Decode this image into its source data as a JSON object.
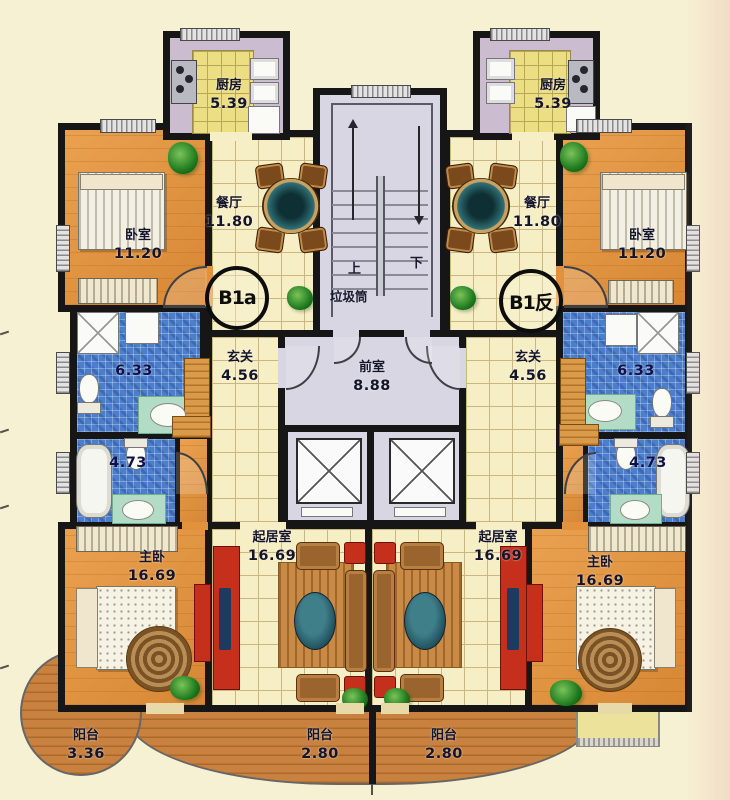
{
  "units": {
    "left": {
      "badge": "B1a",
      "kitchen": {
        "name": "厨房",
        "area": "5.39"
      },
      "dining": {
        "name": "餐厅",
        "area": "11.80"
      },
      "bedroom": {
        "name": "卧室",
        "area": "11.20"
      },
      "foyer": {
        "name": "玄关",
        "area": "4.56"
      },
      "bath_main": {
        "area": "6.33"
      },
      "bath_second": {
        "area": "4.73"
      },
      "living": {
        "name": "起居室",
        "area": "16.69"
      },
      "master": {
        "name": "主卧",
        "area": "16.69"
      },
      "balcony_side": {
        "name": "阳台",
        "area": "3.36"
      },
      "balcony_front": {
        "name": "阳台",
        "area": "2.80"
      }
    },
    "right": {
      "badge": "B1反",
      "kitchen": {
        "name": "厨房",
        "area": "5.39"
      },
      "dining": {
        "name": "餐厅",
        "area": "11.80"
      },
      "bedroom": {
        "name": "卧室",
        "area": "11.20"
      },
      "foyer": {
        "name": "玄关",
        "area": "4.56"
      },
      "bath_main": {
        "area": "6.33"
      },
      "bath_second": {
        "area": "4.73"
      },
      "living": {
        "name": "起居室",
        "area": "16.69"
      },
      "master": {
        "name": "主卧",
        "area": "16.69"
      },
      "balcony_front": {
        "name": "阳台",
        "area": "2.80"
      }
    }
  },
  "core": {
    "lobby": {
      "name": "前室",
      "area": "8.88"
    },
    "stair_up": "上",
    "stair_down": "下",
    "trash_chute": "垃圾筒"
  },
  "colors": {
    "wall": "#161616",
    "floor_tile": "#f6eec4",
    "floor_bedroom": "#e2913c",
    "bath_tile": "#4b7fcb",
    "core_floor": "#d7d6e2",
    "balcony_wood": "#c8813e",
    "kitchen_wall": "#cbbccf",
    "accent_red": "#c4301c",
    "plant_green": "#1e7a1e"
  }
}
